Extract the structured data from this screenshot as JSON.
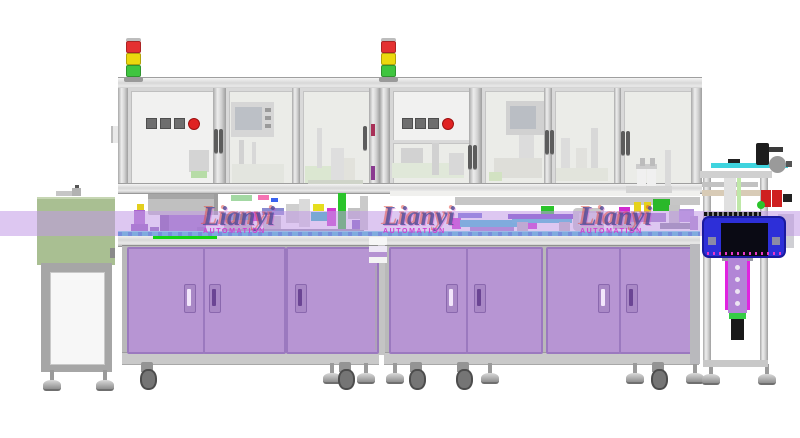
{
  "title": "Automated assembly line - CAD side view render",
  "brand": {
    "watermark_text": "Lianyi",
    "watermark_sub": "AUTOMATION"
  },
  "colors": {
    "door-purple": "#b795d3",
    "door-border": "#9b79bf",
    "panel-white": "#f1f1f0",
    "glass": "#ebece8",
    "lm-green": "#a9bf92",
    "blue-box": "#2d2fd8",
    "stripe": "rgba(193,153,230,0.55)",
    "accent-red": "#e02222",
    "accent-yellow": "#ecd80e",
    "accent-green": "#3fc53f",
    "conveyor-teal": "#2fc2d4",
    "machine-magenta": "#d02cd0",
    "actuator-purple": "#b285d6"
  },
  "watermarks": [
    {
      "x": 203,
      "y": 205
    },
    {
      "x": 383,
      "y": 205
    },
    {
      "x": 580,
      "y": 205
    }
  ],
  "tower_lights": [
    {
      "x": 126,
      "y": 38
    },
    {
      "x": 381,
      "y": 38
    }
  ],
  "tower_segments": [
    "#e43131",
    "#ecd80e",
    "#3fc53f"
  ],
  "control_panels": [
    {
      "y": 118,
      "squares": [
        146,
        160,
        174
      ],
      "round": 188
    },
    {
      "y": 118,
      "squares": [
        402,
        415,
        428
      ],
      "round": 442
    }
  ],
  "cabinet_doors": [
    {
      "x": 127,
      "w": 74
    },
    {
      "x": 203,
      "w": 79
    },
    {
      "x": 286,
      "w": 89
    },
    {
      "x": 389,
      "w": 75
    },
    {
      "x": 466,
      "w": 73
    },
    {
      "x": 546,
      "w": 71
    },
    {
      "x": 619,
      "w": 77
    }
  ],
  "cabinet_handles": [
    {
      "x": 184,
      "light": true
    },
    {
      "x": 209,
      "light": false
    },
    {
      "x": 295,
      "light": false
    },
    {
      "x": 446,
      "light": true
    },
    {
      "x": 474,
      "light": false
    },
    {
      "x": 598,
      "light": true
    },
    {
      "x": 626,
      "light": false
    }
  ],
  "enclosure_handles": [
    {
      "x": 214,
      "y": 129
    },
    {
      "x": 219,
      "y": 129
    },
    {
      "x": 363,
      "y": 126
    },
    {
      "x": 468,
      "y": 145
    },
    {
      "x": 473,
      "y": 145
    },
    {
      "x": 545,
      "y": 130
    },
    {
      "x": 550,
      "y": 130
    },
    {
      "x": 621,
      "y": 131
    },
    {
      "x": 626,
      "y": 131
    }
  ],
  "feet": [
    {
      "t": "foot",
      "x": 42,
      "y": 370
    },
    {
      "t": "foot",
      "x": 95,
      "y": 370
    },
    {
      "t": "caster",
      "x": 139,
      "y": 362
    },
    {
      "t": "foot",
      "x": 322,
      "y": 363
    },
    {
      "t": "caster",
      "x": 337,
      "y": 362
    },
    {
      "t": "foot",
      "x": 356,
      "y": 363
    },
    {
      "t": "foot",
      "x": 385,
      "y": 363
    },
    {
      "t": "caster",
      "x": 408,
      "y": 362
    },
    {
      "t": "caster",
      "x": 455,
      "y": 362
    },
    {
      "t": "foot",
      "x": 480,
      "y": 363
    },
    {
      "t": "foot",
      "x": 625,
      "y": 363
    },
    {
      "t": "caster",
      "x": 650,
      "y": 362
    },
    {
      "t": "foot",
      "x": 685,
      "y": 363
    },
    {
      "t": "foot",
      "x": 701,
      "y": 364
    },
    {
      "t": "foot",
      "x": 757,
      "y": 364
    }
  ],
  "shapes": [
    {
      "x": 56,
      "y": 191,
      "w": 16,
      "h": 5,
      "c": "#c6c6c6",
      "n": "lm-top-part"
    },
    {
      "x": 72,
      "y": 188,
      "w": 9,
      "h": 8,
      "c": "#b2b2b2",
      "n": "lm-top-part"
    },
    {
      "x": 75,
      "y": 185,
      "w": 4,
      "h": 3,
      "c": "#555555",
      "n": "lm-top-part"
    },
    {
      "x": 110,
      "y": 248,
      "w": 5,
      "h": 10,
      "c": "#8a8a8a",
      "n": "lm-latch"
    },
    {
      "x": 111,
      "y": 126,
      "w": 7,
      "h": 17,
      "c": "#e9e9e9",
      "n": "door-hinge"
    },
    {
      "x": 111,
      "y": 126,
      "w": 2,
      "h": 17,
      "c": "#bdbdbd",
      "n": "door-hinge-edge"
    },
    {
      "x": 148,
      "y": 194,
      "w": 70,
      "h": 21,
      "c": "#c0c0c0",
      "r": 2,
      "n": "bowl-feeder-bowl"
    },
    {
      "x": 148,
      "y": 194,
      "w": 70,
      "h": 5,
      "c": "#a6a6a6",
      "n": "bowl-feeder-rim"
    },
    {
      "x": 214,
      "y": 194,
      "w": 4,
      "h": 21,
      "c": "#9e9e9e",
      "n": "bowl-feeder-shade"
    },
    {
      "x": 160,
      "y": 215,
      "w": 46,
      "h": 18,
      "c": "#9a6fc4",
      "n": "bowl-feeder-base"
    },
    {
      "x": 160,
      "y": 215,
      "w": 9,
      "h": 18,
      "c": "#7e55a8",
      "n": "bowl-feeder-base-shade"
    },
    {
      "x": 150,
      "y": 227,
      "w": 9,
      "h": 9,
      "c": "#8a5fb5"
    },
    {
      "x": 197,
      "y": 227,
      "w": 9,
      "h": 9,
      "c": "#8a5fb5"
    },
    {
      "x": 153,
      "y": 236,
      "w": 64,
      "h": 3,
      "c": "#12d412",
      "n": "green-line"
    },
    {
      "x": 134,
      "y": 210,
      "w": 11,
      "h": 24,
      "c": "#aa66cc"
    },
    {
      "x": 131,
      "y": 224,
      "w": 17,
      "h": 10,
      "c": "#9257bd"
    },
    {
      "x": 137,
      "y": 204,
      "w": 7,
      "h": 6,
      "c": "#e3cf1d"
    },
    {
      "x": 222,
      "y": 214,
      "w": 32,
      "h": 6,
      "c": "#35c0d0"
    },
    {
      "x": 251,
      "y": 212,
      "w": 9,
      "h": 9,
      "c": "#cf2ccf"
    },
    {
      "x": 224,
      "y": 220,
      "w": 28,
      "h": 13,
      "c": "#bbbbbb"
    },
    {
      "x": 262,
      "y": 208,
      "w": 22,
      "h": 7,
      "c": "#8a8ad0"
    },
    {
      "x": 263,
      "y": 216,
      "w": 18,
      "h": 16,
      "c": "#c6c6c6"
    },
    {
      "x": 286,
      "y": 204,
      "w": 13,
      "h": 19,
      "c": "#cfcfcf"
    },
    {
      "x": 299,
      "y": 199,
      "w": 11,
      "h": 28,
      "c": "#dadada"
    },
    {
      "x": 311,
      "y": 212,
      "w": 17,
      "h": 9,
      "c": "#22b8c2"
    },
    {
      "x": 313,
      "y": 204,
      "w": 11,
      "h": 7,
      "c": "#e6de1e"
    },
    {
      "x": 327,
      "y": 208,
      "w": 9,
      "h": 18,
      "c": "#cf3ccf"
    },
    {
      "x": 338,
      "y": 193,
      "w": 8,
      "h": 41,
      "c": "#2ac42a",
      "n": "din-rail"
    },
    {
      "x": 348,
      "y": 208,
      "w": 15,
      "h": 11,
      "c": "#c2c2c2"
    },
    {
      "x": 352,
      "y": 220,
      "w": 13,
      "h": 9,
      "c": "#8162c2"
    },
    {
      "x": 231,
      "y": 195,
      "w": 21,
      "h": 6,
      "c": "#a3d8a3"
    },
    {
      "x": 258,
      "y": 195,
      "w": 11,
      "h": 5,
      "c": "#f573b3"
    },
    {
      "x": 271,
      "y": 198,
      "w": 7,
      "h": 4,
      "c": "#3a63f0"
    },
    {
      "x": 222,
      "y": 229,
      "w": 142,
      "h": 3,
      "c": "#9595a8"
    },
    {
      "x": 360,
      "y": 196,
      "w": 8,
      "h": 34,
      "c": "#cacaca"
    },
    {
      "x": 371,
      "y": 124,
      "w": 4,
      "h": 12,
      "c": "#a83058"
    },
    {
      "x": 371,
      "y": 166,
      "w": 4,
      "h": 14,
      "c": "#8a3a90"
    },
    {
      "x": 369,
      "y": 237,
      "w": 18,
      "h": 8,
      "c": "#f6f6f6",
      "r": 1,
      "n": "tray-stack"
    },
    {
      "x": 369,
      "y": 246,
      "w": 18,
      "h": 6,
      "c": "#ede7f5",
      "n": "tray-stack"
    },
    {
      "x": 369,
      "y": 252,
      "w": 18,
      "h": 5,
      "c": "#b593d2",
      "n": "tray-stack"
    },
    {
      "x": 369,
      "y": 257,
      "w": 18,
      "h": 6,
      "c": "#f4f4f4",
      "n": "tray-stack"
    },
    {
      "x": 375,
      "y": 266,
      "w": 2,
      "h": 84,
      "c": "#aaaaaa",
      "o": 0.6
    },
    {
      "x": 390,
      "y": 191,
      "w": 310,
      "h": 5,
      "c": "#f0f0ee"
    },
    {
      "x": 455,
      "y": 197,
      "w": 245,
      "h": 8,
      "c": "#c6c6c6",
      "n": "cross-beam"
    },
    {
      "x": 452,
      "y": 218,
      "w": 9,
      "h": 11,
      "c": "#d02cd0"
    },
    {
      "x": 460,
      "y": 220,
      "w": 70,
      "h": 7,
      "c": "#32c2d2",
      "n": "conveyor-module"
    },
    {
      "x": 528,
      "y": 218,
      "w": 9,
      "h": 11,
      "c": "#d02cd0"
    },
    {
      "x": 470,
      "y": 227,
      "w": 44,
      "h": 8,
      "c": "#9d7cc8"
    },
    {
      "x": 458,
      "y": 213,
      "w": 24,
      "h": 5,
      "c": "#6f6fd8"
    },
    {
      "x": 508,
      "y": 214,
      "w": 70,
      "h": 5,
      "c": "#7148c8"
    },
    {
      "x": 512,
      "y": 219,
      "w": 60,
      "h": 4,
      "c": "#35c5d5"
    },
    {
      "x": 541,
      "y": 206,
      "w": 13,
      "h": 8,
      "c": "#2ac42a"
    },
    {
      "x": 517,
      "y": 222,
      "w": 11,
      "h": 13,
      "c": "#bcbcbc"
    },
    {
      "x": 559,
      "y": 222,
      "w": 11,
      "h": 13,
      "c": "#bcbcbc"
    },
    {
      "x": 573,
      "y": 208,
      "w": 31,
      "h": 23,
      "c": "#c9c9c9",
      "r": 4,
      "n": "station-unit"
    },
    {
      "x": 579,
      "y": 213,
      "w": 19,
      "h": 13,
      "c": "#dcdcdc"
    },
    {
      "x": 613,
      "y": 214,
      "w": 24,
      "h": 15,
      "c": "#bcbcbc"
    },
    {
      "x": 619,
      "y": 207,
      "w": 11,
      "h": 8,
      "c": "#d02cd0"
    },
    {
      "x": 634,
      "y": 202,
      "w": 7,
      "h": 10,
      "c": "#e6d21a"
    },
    {
      "x": 644,
      "y": 202,
      "w": 7,
      "h": 10,
      "c": "#e6d21a"
    },
    {
      "x": 630,
      "y": 213,
      "w": 36,
      "h": 9,
      "c": "#9d7cc8"
    },
    {
      "x": 653,
      "y": 199,
      "w": 17,
      "h": 12,
      "c": "#2ab82a"
    },
    {
      "x": 669,
      "y": 205,
      "w": 11,
      "h": 20,
      "c": "#c4c4c4"
    },
    {
      "x": 679,
      "y": 209,
      "w": 15,
      "h": 13,
      "c": "#b291da"
    },
    {
      "x": 660,
      "y": 223,
      "w": 36,
      "h": 6,
      "c": "#8d8da0"
    },
    {
      "x": 690,
      "y": 216,
      "w": 8,
      "h": 14,
      "c": "#aa88cc"
    },
    {
      "x": 189,
      "y": 150,
      "w": 20,
      "h": 22,
      "c": "#d4d4d4",
      "n": "door-device"
    },
    {
      "x": 191,
      "y": 171,
      "w": 16,
      "h": 7,
      "c": "#b7dca7"
    },
    {
      "x": 231,
      "y": 102,
      "w": 43,
      "h": 35,
      "c": "#d6d6d6",
      "n": "hmi-box"
    },
    {
      "x": 235,
      "y": 107,
      "w": 27,
      "h": 23,
      "c": "#bcc0c6",
      "n": "hmi-screen"
    },
    {
      "x": 265,
      "y": 108,
      "w": 6,
      "h": 4,
      "c": "#9a9a9a"
    },
    {
      "x": 265,
      "y": 116,
      "w": 6,
      "h": 4,
      "c": "#9a9a9a"
    },
    {
      "x": 265,
      "y": 124,
      "w": 6,
      "h": 4,
      "c": "#9a9a9a"
    },
    {
      "x": 239,
      "y": 140,
      "w": 5,
      "h": 42,
      "c": "#d2d2d2"
    },
    {
      "x": 252,
      "y": 142,
      "w": 4,
      "h": 40,
      "c": "#d8d8d8"
    },
    {
      "x": 232,
      "y": 164,
      "w": 52,
      "h": 19,
      "c": "#e3e5df"
    },
    {
      "x": 305,
      "y": 166,
      "w": 30,
      "h": 17,
      "c": "#dbe7d1"
    },
    {
      "x": 331,
      "y": 148,
      "w": 13,
      "h": 35,
      "c": "#dedede"
    },
    {
      "x": 344,
      "y": 158,
      "w": 11,
      "h": 25,
      "c": "#e2e2dc"
    },
    {
      "x": 317,
      "y": 128,
      "w": 5,
      "h": 40,
      "c": "#dadada"
    },
    {
      "x": 308,
      "y": 180,
      "w": 55,
      "h": 4,
      "c": "#cfd4c9"
    },
    {
      "x": 392,
      "y": 163,
      "w": 72,
      "h": 15,
      "c": "#e0e8d9"
    },
    {
      "x": 401,
      "y": 148,
      "w": 22,
      "h": 15,
      "c": "#d2d2d2"
    },
    {
      "x": 432,
      "y": 143,
      "w": 7,
      "h": 32,
      "c": "#d1d1d1"
    },
    {
      "x": 449,
      "y": 153,
      "w": 15,
      "h": 22,
      "c": "#d8d8d8"
    },
    {
      "x": 506,
      "y": 101,
      "w": 38,
      "h": 34,
      "c": "#d1d1d1",
      "n": "hmi-box"
    },
    {
      "x": 510,
      "y": 106,
      "w": 26,
      "h": 23,
      "c": "#babec4",
      "n": "hmi-screen"
    },
    {
      "x": 519,
      "y": 135,
      "w": 15,
      "h": 28,
      "c": "#dcdcdc"
    },
    {
      "x": 494,
      "y": 158,
      "w": 48,
      "h": 20,
      "c": "#deded9"
    },
    {
      "x": 489,
      "y": 172,
      "w": 13,
      "h": 9,
      "c": "#d2e2c2"
    },
    {
      "x": 561,
      "y": 138,
      "w": 9,
      "h": 42,
      "c": "#dcdcdc"
    },
    {
      "x": 576,
      "y": 148,
      "w": 11,
      "h": 32,
      "c": "#e1e1dd"
    },
    {
      "x": 591,
      "y": 128,
      "w": 7,
      "h": 52,
      "c": "#d8d8d8"
    },
    {
      "x": 556,
      "y": 168,
      "w": 52,
      "h": 13,
      "c": "#e2e4dc"
    },
    {
      "x": 637,
      "y": 168,
      "w": 9,
      "h": 26,
      "c": "#f0f0f0",
      "n": "bottle"
    },
    {
      "x": 647,
      "y": 168,
      "w": 9,
      "h": 26,
      "c": "#f0f0f0",
      "n": "bottle"
    },
    {
      "x": 636,
      "y": 164,
      "w": 21,
      "h": 5,
      "c": "#cccccc"
    },
    {
      "x": 640,
      "y": 158,
      "w": 5,
      "h": 8,
      "c": "#bcbcbc"
    },
    {
      "x": 650,
      "y": 158,
      "w": 5,
      "h": 8,
      "c": "#bcbcbc"
    },
    {
      "x": 626,
      "y": 186,
      "w": 46,
      "h": 7,
      "c": "#d4d4d4"
    },
    {
      "x": 665,
      "y": 150,
      "w": 6,
      "h": 36,
      "c": "#dadada"
    }
  ],
  "right_station": {
    "posts": [
      {
        "x": 703,
        "y": 171,
        "w": 8,
        "h": 196
      },
      {
        "x": 760,
        "y": 171,
        "w": 8,
        "h": 196
      }
    ],
    "parts_low": [
      {
        "x": 690,
        "y": 244,
        "w": 10,
        "h": 120,
        "c": "#b9b9bd",
        "n": "end-panel"
      },
      {
        "x": 778,
        "y": 214,
        "w": 16,
        "h": 34,
        "c": "#cfcfd4",
        "n": "side-box"
      },
      {
        "x": 702,
        "y": 182,
        "w": 56,
        "h": 5,
        "c": "#c2c2c2",
        "n": "tube"
      },
      {
        "x": 702,
        "y": 190,
        "w": 58,
        "h": 6,
        "c": "#d8cbb6",
        "n": "tube"
      },
      {
        "x": 724,
        "y": 176,
        "w": 12,
        "h": 38,
        "c": "#e0e0e0",
        "n": "slide"
      },
      {
        "x": 737,
        "y": 178,
        "w": 4,
        "h": 36,
        "c": "#bfe8a8",
        "n": "slide-rail"
      },
      {
        "x": 703,
        "y": 360,
        "w": 65,
        "h": 7,
        "c": "#c8c8c8",
        "n": "lower-beam"
      },
      {
        "x": 725,
        "y": 258,
        "w": 3,
        "h": 52,
        "c": "#e023e0",
        "n": "actuator-rail"
      },
      {
        "x": 747,
        "y": 258,
        "w": 3,
        "h": 52,
        "c": "#e023e0",
        "n": "actuator-rail"
      },
      {
        "x": 722,
        "y": 255,
        "w": 31,
        "h": 6,
        "c": "#9a9aa4",
        "n": "actuator-mount"
      },
      {
        "x": 728,
        "y": 257,
        "w": 19,
        "h": 56,
        "c": "#b285d6",
        "n": "actuator-column"
      },
      {
        "x": 735,
        "y": 265,
        "w": 5,
        "h": 5,
        "c": "#ece4f2",
        "r": 3,
        "n": "actuator-hole"
      },
      {
        "x": 735,
        "y": 277,
        "w": 5,
        "h": 5,
        "c": "#ece4f2",
        "r": 3,
        "n": "actuator-hole"
      },
      {
        "x": 735,
        "y": 289,
        "w": 5,
        "h": 5,
        "c": "#ece4f2",
        "r": 3,
        "n": "actuator-hole"
      },
      {
        "x": 735,
        "y": 301,
        "w": 5,
        "h": 5,
        "c": "#ece4f2",
        "r": 3,
        "n": "actuator-hole"
      },
      {
        "x": 729,
        "y": 313,
        "w": 17,
        "h": 6,
        "c": "#35cc45",
        "n": "actuator-band"
      },
      {
        "x": 731,
        "y": 319,
        "w": 13,
        "h": 21,
        "c": "#191919",
        "n": "gripper-cylinder"
      }
    ],
    "parts_high": [
      {
        "x": 700,
        "y": 171,
        "w": 72,
        "h": 7,
        "c": "#d0d0d0",
        "n": "top-beam"
      },
      {
        "x": 711,
        "y": 163,
        "w": 77,
        "h": 5,
        "c": "#3fd4de",
        "n": "cyan-plate"
      },
      {
        "x": 728,
        "y": 159,
        "w": 12,
        "h": 4,
        "c": "#222222",
        "n": "plate-chip"
      },
      {
        "x": 756,
        "y": 143,
        "w": 13,
        "h": 22,
        "c": "#1d1d1d",
        "r": 2,
        "n": "motor"
      },
      {
        "x": 769,
        "y": 147,
        "w": 14,
        "h": 5,
        "c": "#3a3a3a",
        "n": "motor-connector"
      },
      {
        "x": 769,
        "y": 156,
        "w": 17,
        "h": 17,
        "c": "#9a9a9a",
        "r": 9,
        "n": "handwheel"
      },
      {
        "x": 786,
        "y": 161,
        "w": 6,
        "h": 6,
        "c": "#555555",
        "n": "handwheel-axle"
      },
      {
        "x": 761,
        "y": 190,
        "w": 10,
        "h": 17,
        "c": "#cf1f1f",
        "n": "clamp-red"
      },
      {
        "x": 772,
        "y": 190,
        "w": 10,
        "h": 17,
        "c": "#cf1f1f",
        "n": "clamp-red"
      },
      {
        "x": 783,
        "y": 194,
        "w": 9,
        "h": 8,
        "c": "#222222",
        "n": "clamp-knob"
      },
      {
        "x": 757,
        "y": 201,
        "w": 8,
        "h": 8,
        "c": "#2bc42b",
        "r": 4,
        "n": "green-button"
      },
      {
        "x": 704,
        "y": 212,
        "w": 57,
        "h": 4,
        "c": "#111111",
        "n": "rack-strip"
      }
    ]
  }
}
